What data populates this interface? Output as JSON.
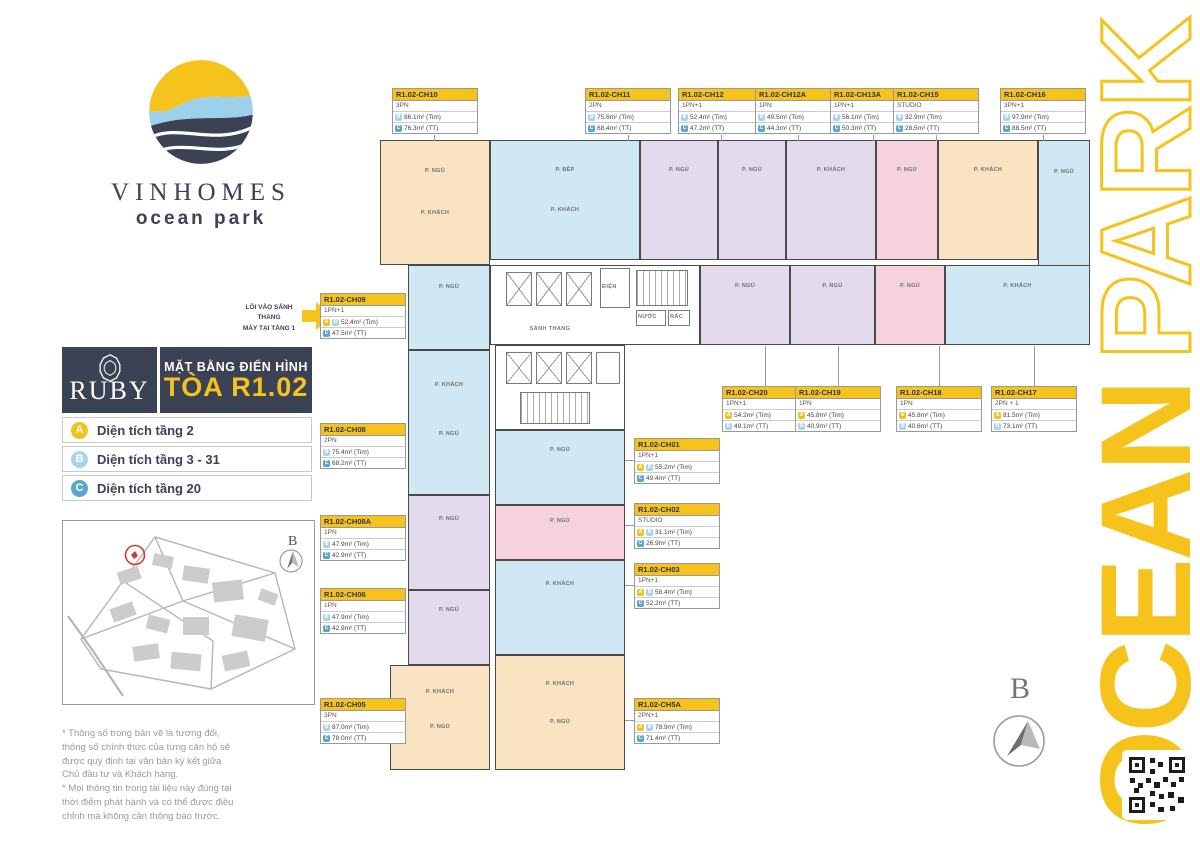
{
  "brand": {
    "name": "VINHOMES",
    "sub": "ocean park"
  },
  "entrance_note": {
    "line1": "LỐI VÀO SẢNH THANG",
    "line2": "MÁY TẠI TẦNG 1"
  },
  "title_block": {
    "logo": "RUBY",
    "subtitle": "MẶT BẰNG ĐIỂN HÌNH",
    "title": "TÒA R1.02"
  },
  "legend": {
    "items": [
      {
        "badge": "A",
        "color": "#F2C21C",
        "label": "Diện tích tầng 2"
      },
      {
        "badge": "B",
        "color": "#A9D4EC",
        "label": "Diện tích tầng 3 - 31"
      },
      {
        "badge": "C",
        "color": "#57A7CE",
        "label": "Diện tích tầng 20"
      }
    ]
  },
  "site_map": {
    "compass_label": "B"
  },
  "disclaimer": {
    "paragraphs": [
      "* Thông số trong bản vẽ là tương đối, thông số chính thức của từng căn hộ sẽ được quy định tại văn bản ký kết giữa Chủ đầu tư và Khách hàng.",
      "* Mọi thông tin trong tài liệu này đúng tại thời điểm phát hành và có thể được điều chỉnh mà không cần thông báo trước."
    ]
  },
  "side_banner": {
    "word_bottom": "OCEAN",
    "word_top": "PARK",
    "color": "#F6C31C"
  },
  "compass": {
    "label": "B"
  },
  "plan": {
    "colors": {
      "cream": "#FAE3C1",
      "blue": "#CFE8F4",
      "lavender": "#E3DAEE",
      "pink": "#F5D2DC"
    },
    "core_labels": {
      "lobby": "SẢNH THANG",
      "electric": "ĐIỆN",
      "water": "NƯỚC",
      "trash": "RÁC"
    },
    "units": [
      {
        "id": "CH10",
        "color": "cream",
        "rooms": [
          "P. NGỦ",
          "P. KHÁCH"
        ]
      },
      {
        "id": "CH09",
        "color": "blue",
        "rooms": [
          "P. NGỦ"
        ]
      },
      {
        "id": "CH08",
        "color": "blue",
        "rooms": [
          "P. KHÁCH",
          "P. NGỦ"
        ]
      },
      {
        "id": "CH08A",
        "color": "lavender",
        "rooms": [
          "P. NGỦ"
        ]
      },
      {
        "id": "CH06",
        "color": "lavender",
        "rooms": [
          "P. NGỦ"
        ]
      },
      {
        "id": "CH05",
        "color": "cream",
        "rooms": [
          "P. KHÁCH",
          "P. NGỦ"
        ]
      },
      {
        "id": "CH11",
        "color": "blue",
        "rooms": [
          "P. BẾP",
          "P. KHÁCH"
        ]
      },
      {
        "id": "CH12",
        "color": "lavender",
        "rooms": [
          "P. NGỦ"
        ]
      },
      {
        "id": "CH12A",
        "color": "lavender",
        "rooms": [
          "P. NGỦ"
        ]
      },
      {
        "id": "CH13A",
        "color": "lavender",
        "rooms": [
          "P. KHÁCH"
        ]
      },
      {
        "id": "CH15",
        "color": "pink",
        "rooms": [
          "P. NGỦ"
        ]
      },
      {
        "id": "CH16",
        "color": "cream",
        "rooms": [
          "P. KHÁCH"
        ]
      },
      {
        "id": "CH17",
        "color": "blue",
        "rooms": [
          "P. NGỦ"
        ]
      },
      {
        "id": "CH20",
        "color": "lavender",
        "rooms": [
          "P. NGỦ"
        ]
      },
      {
        "id": "CH19",
        "color": "lavender",
        "rooms": [
          "P. NGỦ"
        ]
      },
      {
        "id": "CH18",
        "color": "pink",
        "rooms": [
          "P. NGỦ"
        ]
      },
      {
        "id": "CH17",
        "color": "blue",
        "rooms": [
          "P. KHÁCH"
        ]
      },
      {
        "id": "CH01",
        "color": "blue",
        "rooms": [
          "P. NGỦ"
        ]
      },
      {
        "id": "CH02",
        "color": "pink",
        "rooms": [
          "P. NGỦ"
        ]
      },
      {
        "id": "CH03",
        "color": "blue",
        "rooms": [
          "P. KHÁCH"
        ]
      },
      {
        "id": "CH5A",
        "color": "cream",
        "rooms": [
          "P. KHÁCH",
          "P. NGỦ"
        ]
      }
    ],
    "labels": [
      {
        "id": "R1.02-CH10",
        "type": "3PN",
        "rows": [
          {
            "badges": [
              "B"
            ],
            "value": "86.1m² (Tim)"
          },
          {
            "badges": [
              "C"
            ],
            "value": "76.3m² (TT)"
          }
        ]
      },
      {
        "id": "R1.02-CH11",
        "type": "2PN",
        "rows": [
          {
            "badges": [
              "B"
            ],
            "value": "75.6m² (Tim)"
          },
          {
            "badges": [
              "C"
            ],
            "value": "68.4m² (TT)"
          }
        ]
      },
      {
        "id": "R1.02-CH12",
        "type": "1PN+1",
        "rows": [
          {
            "badges": [
              "B"
            ],
            "value": "52.4m² (Tim)"
          },
          {
            "badges": [
              "C"
            ],
            "value": "47.2m² (TT)"
          }
        ]
      },
      {
        "id": "R1.02-CH12A",
        "type": "1PN",
        "rows": [
          {
            "badges": [
              "B"
            ],
            "value": "49.5m² (Tim)"
          },
          {
            "badges": [
              "C"
            ],
            "value": "44.3m² (TT)"
          }
        ]
      },
      {
        "id": "R1.02-CH13A",
        "type": "1PN+1",
        "rows": [
          {
            "badges": [
              "B"
            ],
            "value": "56.1m² (Tim)"
          },
          {
            "badges": [
              "C"
            ],
            "value": "50.3m² (TT)"
          }
        ]
      },
      {
        "id": "R1.02-CH15",
        "type": "STUDIO",
        "rows": [
          {
            "badges": [
              "B"
            ],
            "value": "32.9m² (Tim)"
          },
          {
            "badges": [
              "C"
            ],
            "value": "28.5m² (TT)"
          }
        ]
      },
      {
        "id": "R1.02-CH16",
        "type": "3PN+1",
        "rows": [
          {
            "badges": [
              "B"
            ],
            "value": "97.9m² (Tim)"
          },
          {
            "badges": [
              "C"
            ],
            "value": "88.5m² (TT)"
          }
        ]
      },
      {
        "id": "R1.02-CH09",
        "type": "1PN+1",
        "rows": [
          {
            "badges": [
              "A",
              "B"
            ],
            "value": "52.4m² (Tim)"
          },
          {
            "badges": [
              "C"
            ],
            "value": "47.5m² (TT)"
          }
        ]
      },
      {
        "id": "R1.02-CH08",
        "type": "2PN",
        "rows": [
          {
            "badges": [
              "B"
            ],
            "value": "75.4m² (Tim)"
          },
          {
            "badges": [
              "C"
            ],
            "value": "68.2m² (TT)"
          }
        ]
      },
      {
        "id": "R1.02-CH08A",
        "type": "1PN",
        "rows": [
          {
            "badges": [
              "B"
            ],
            "value": "47.9m² (Tim)"
          },
          {
            "badges": [
              "C"
            ],
            "value": "42.9m² (TT)"
          }
        ]
      },
      {
        "id": "R1.02-CH06",
        "type": "1PN",
        "rows": [
          {
            "badges": [
              "B"
            ],
            "value": "47.9m² (Tim)"
          },
          {
            "badges": [
              "C"
            ],
            "value": "42.9m² (TT)"
          }
        ]
      },
      {
        "id": "R1.02-CH05",
        "type": "3PN",
        "rows": [
          {
            "badges": [
              "B"
            ],
            "value": "87.0m² (Tim)"
          },
          {
            "badges": [
              "C"
            ],
            "value": "78.0m² (TT)"
          }
        ]
      },
      {
        "id": "R1.02-CH01",
        "type": "1PN+1",
        "rows": [
          {
            "badges": [
              "A",
              "B"
            ],
            "value": "55.2m² (Tim)"
          },
          {
            "badges": [
              "C"
            ],
            "value": "49.4m² (TT)"
          }
        ]
      },
      {
        "id": "R1.02-CH02",
        "type": "STUDIO",
        "rows": [
          {
            "badges": [
              "A",
              "B"
            ],
            "value": "31.1m² (Tim)"
          },
          {
            "badges": [
              "C"
            ],
            "value": "26.9m² (TT)"
          }
        ]
      },
      {
        "id": "R1.02-CH03",
        "type": "1PN+1",
        "rows": [
          {
            "badges": [
              "A",
              "B"
            ],
            "value": "58.4m² (Tim)"
          },
          {
            "badges": [
              "C"
            ],
            "value": "52.2m² (TT)"
          }
        ]
      },
      {
        "id": "R1.02-CH5A",
        "type": "2PN+1",
        "rows": [
          {
            "badges": [
              "A",
              "B"
            ],
            "value": "78.9m² (Tim)"
          },
          {
            "badges": [
              "C"
            ],
            "value": "71.4m² (TT)"
          }
        ]
      },
      {
        "id": "R1.02-CH20",
        "type": "1PN+1",
        "rows": [
          {
            "badges": [
              "A"
            ],
            "value": "54.2m² (Tim)"
          },
          {
            "badges": [
              "B"
            ],
            "value": "49.1m² (TT)"
          }
        ]
      },
      {
        "id": "R1.02-CH19",
        "type": "1PN",
        "rows": [
          {
            "badges": [
              "A"
            ],
            "value": "45.8m² (Tim)"
          },
          {
            "badges": [
              "B"
            ],
            "value": "40.9m² (TT)"
          }
        ]
      },
      {
        "id": "R1.02-CH18",
        "type": "1PN",
        "rows": [
          {
            "badges": [
              "A"
            ],
            "value": "45.8m² (Tim)"
          },
          {
            "badges": [
              "B"
            ],
            "value": "40.6m² (TT)"
          }
        ]
      },
      {
        "id": "R1.02-CH17",
        "type": "2PN + 1",
        "rows": [
          {
            "badges": [
              "A"
            ],
            "value": "81.5m² (Tim)"
          },
          {
            "badges": [
              "B"
            ],
            "value": "73.1m² (TT)"
          }
        ]
      }
    ]
  }
}
